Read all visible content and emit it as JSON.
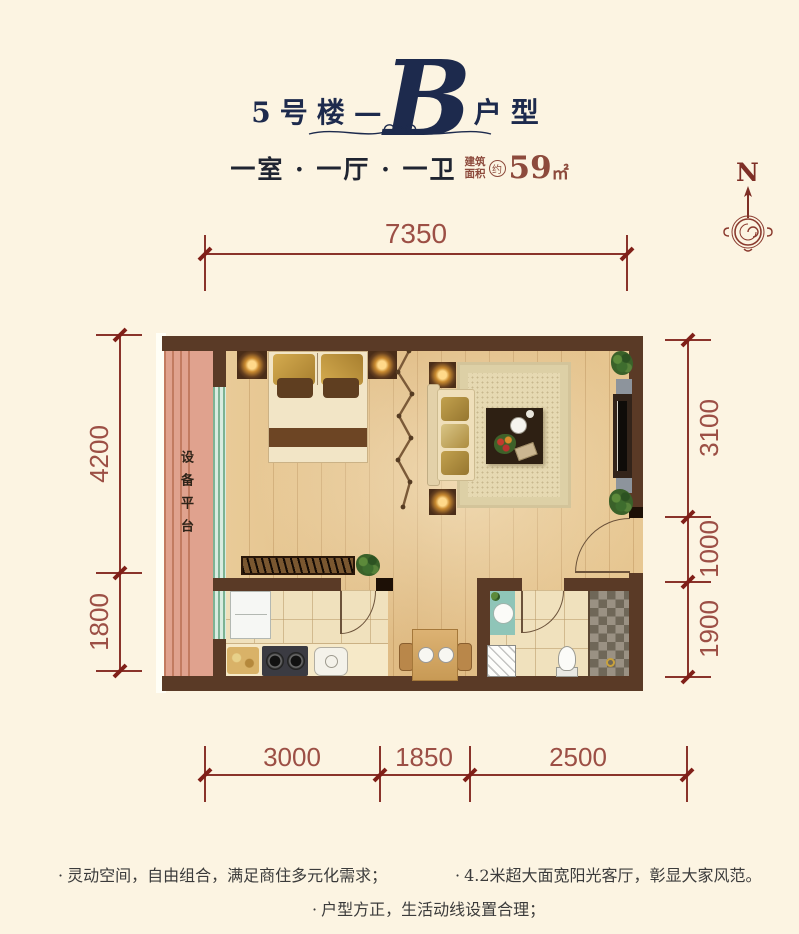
{
  "title": {
    "building": "5号楼",
    "dash": "—",
    "unit_letter": "B",
    "suffix": "户型"
  },
  "subtitle": {
    "rooms": "一室 · 一厅 · 一卫",
    "area_label_line1": "建筑",
    "area_label_line2": "面积",
    "area_approx": "约",
    "area_value": "59",
    "area_unit": "㎡"
  },
  "compass": {
    "north": "N"
  },
  "dims": {
    "top": [
      "7350"
    ],
    "left": [
      "4200",
      "1800"
    ],
    "right": [
      "3100",
      "1000",
      "1900"
    ],
    "bottom": [
      "3000",
      "1850",
      "2500"
    ]
  },
  "plan": {
    "platform_label": "设备平台"
  },
  "features": {
    "bullet": "·",
    "items": [
      "灵动空间，自由组合，满足商住多元化需求；",
      "4.2米超大面宽阳光客厅，彰显大家风范。",
      "户型方正，生活动线设置合理；"
    ]
  },
  "colors": {
    "background": "#fcf4e2",
    "title_navy": "#1d2a4d",
    "dimension_red": "#9c4f45",
    "area_red_brown": "#8d4a3c",
    "wall_brown": "#5a3a26",
    "platform_salmon": "#dfa28e",
    "wood_floor": "#e3bf88",
    "window_green": "#7db394",
    "compass_red": "#7e2f26"
  }
}
